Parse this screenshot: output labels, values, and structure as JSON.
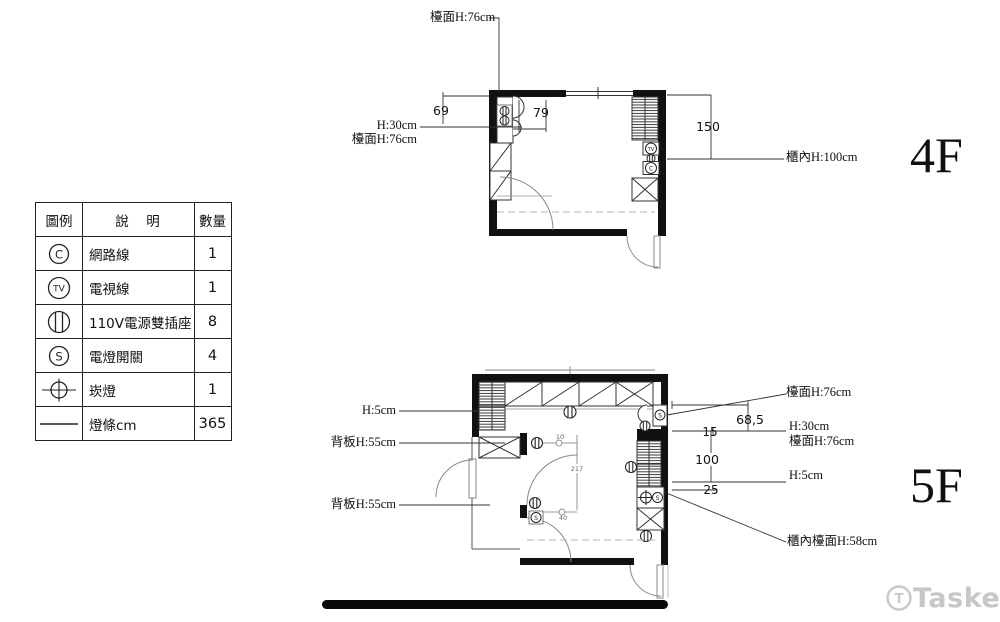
{
  "legend": {
    "headers": {
      "symbol": "圖例",
      "description": "說　明",
      "quantity": "數量"
    },
    "rows": [
      {
        "symbol_letter": "C",
        "description": "網路線",
        "quantity": "1"
      },
      {
        "symbol_letter": "TV",
        "description": "電視線",
        "quantity": "1"
      },
      {
        "symbol_letter": "",
        "description": "110V電源雙插座",
        "quantity": "8"
      },
      {
        "symbol_letter": "S",
        "description": "電燈開關",
        "quantity": "4"
      },
      {
        "symbol_letter": "",
        "description": "崁燈",
        "quantity": "1"
      },
      {
        "symbol_letter": "",
        "description": "燈條cm",
        "quantity": "365"
      }
    ]
  },
  "symbols": {
    "c": "C",
    "tv": "TV",
    "s": "S"
  },
  "floor4": {
    "name": "4F",
    "labels": {
      "counter_top": "檯面H:76cm",
      "h30": "H:30cm",
      "counter_left": "檯面H:76cm",
      "cabinet_inner": "櫃內H:100cm"
    },
    "dims": {
      "d69": "69",
      "d79": "79",
      "d150": "150"
    }
  },
  "floor5": {
    "name": "5F",
    "labels": {
      "h5_left": "H:5cm",
      "back1": "背板H:55cm",
      "back2": "背板H:55cm",
      "counter_right": "檯面H:76cm",
      "h30": "H:30cm",
      "counter_right2": "檯面H:76cm",
      "h5_right": "H:5cm",
      "cabinet_counter": "櫃內檯面H:58cm"
    },
    "dims": {
      "d685": "68,5",
      "d15": "15",
      "d100": "100",
      "d25": "25",
      "d217": "217",
      "d10": "10",
      "d40": "40"
    }
  },
  "watermark": {
    "brand": "Tasker",
    "icon_letter": "T"
  }
}
